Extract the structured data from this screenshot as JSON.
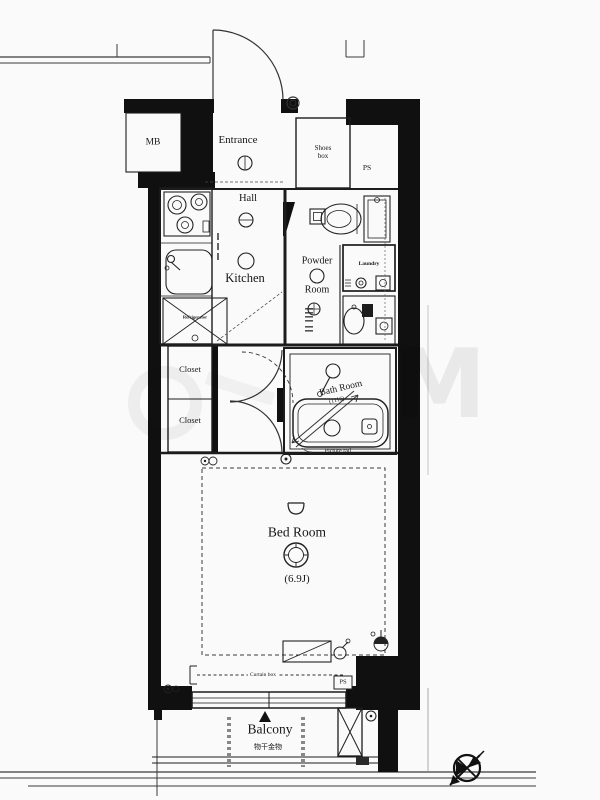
{
  "colors": {
    "wall": "#101010",
    "line": "#222222",
    "background": "#fafafa",
    "label": "#161616"
  },
  "rooms": {
    "entrance": "Entrance",
    "hall": "Hall",
    "kitchen": "Kitchen",
    "powder_room_line1": "Powder",
    "powder_room_line2": "Room",
    "laundry": "Laundry",
    "bath_room": "Bath Room",
    "bath_room_size": "(1116)",
    "closet_upper": "Closet",
    "closet_lower": "Closet",
    "bed_room": "Bed Room",
    "bed_room_size": "(6.9J)",
    "balcony": "Balcony"
  },
  "annotations": {
    "mb": "MB",
    "ps_top": "PS",
    "ps_bottom": "PS",
    "shoes_box_line1": "Shoes",
    "shoes_box_line2": "box",
    "refrigerator": "Refrigerator",
    "picture_rail": "Picture rail",
    "curtain_box": "Curtain box",
    "balcony_note": "物干金物",
    "watermark": "M"
  },
  "icons": {
    "north_arrow": "north-arrow-compass"
  }
}
